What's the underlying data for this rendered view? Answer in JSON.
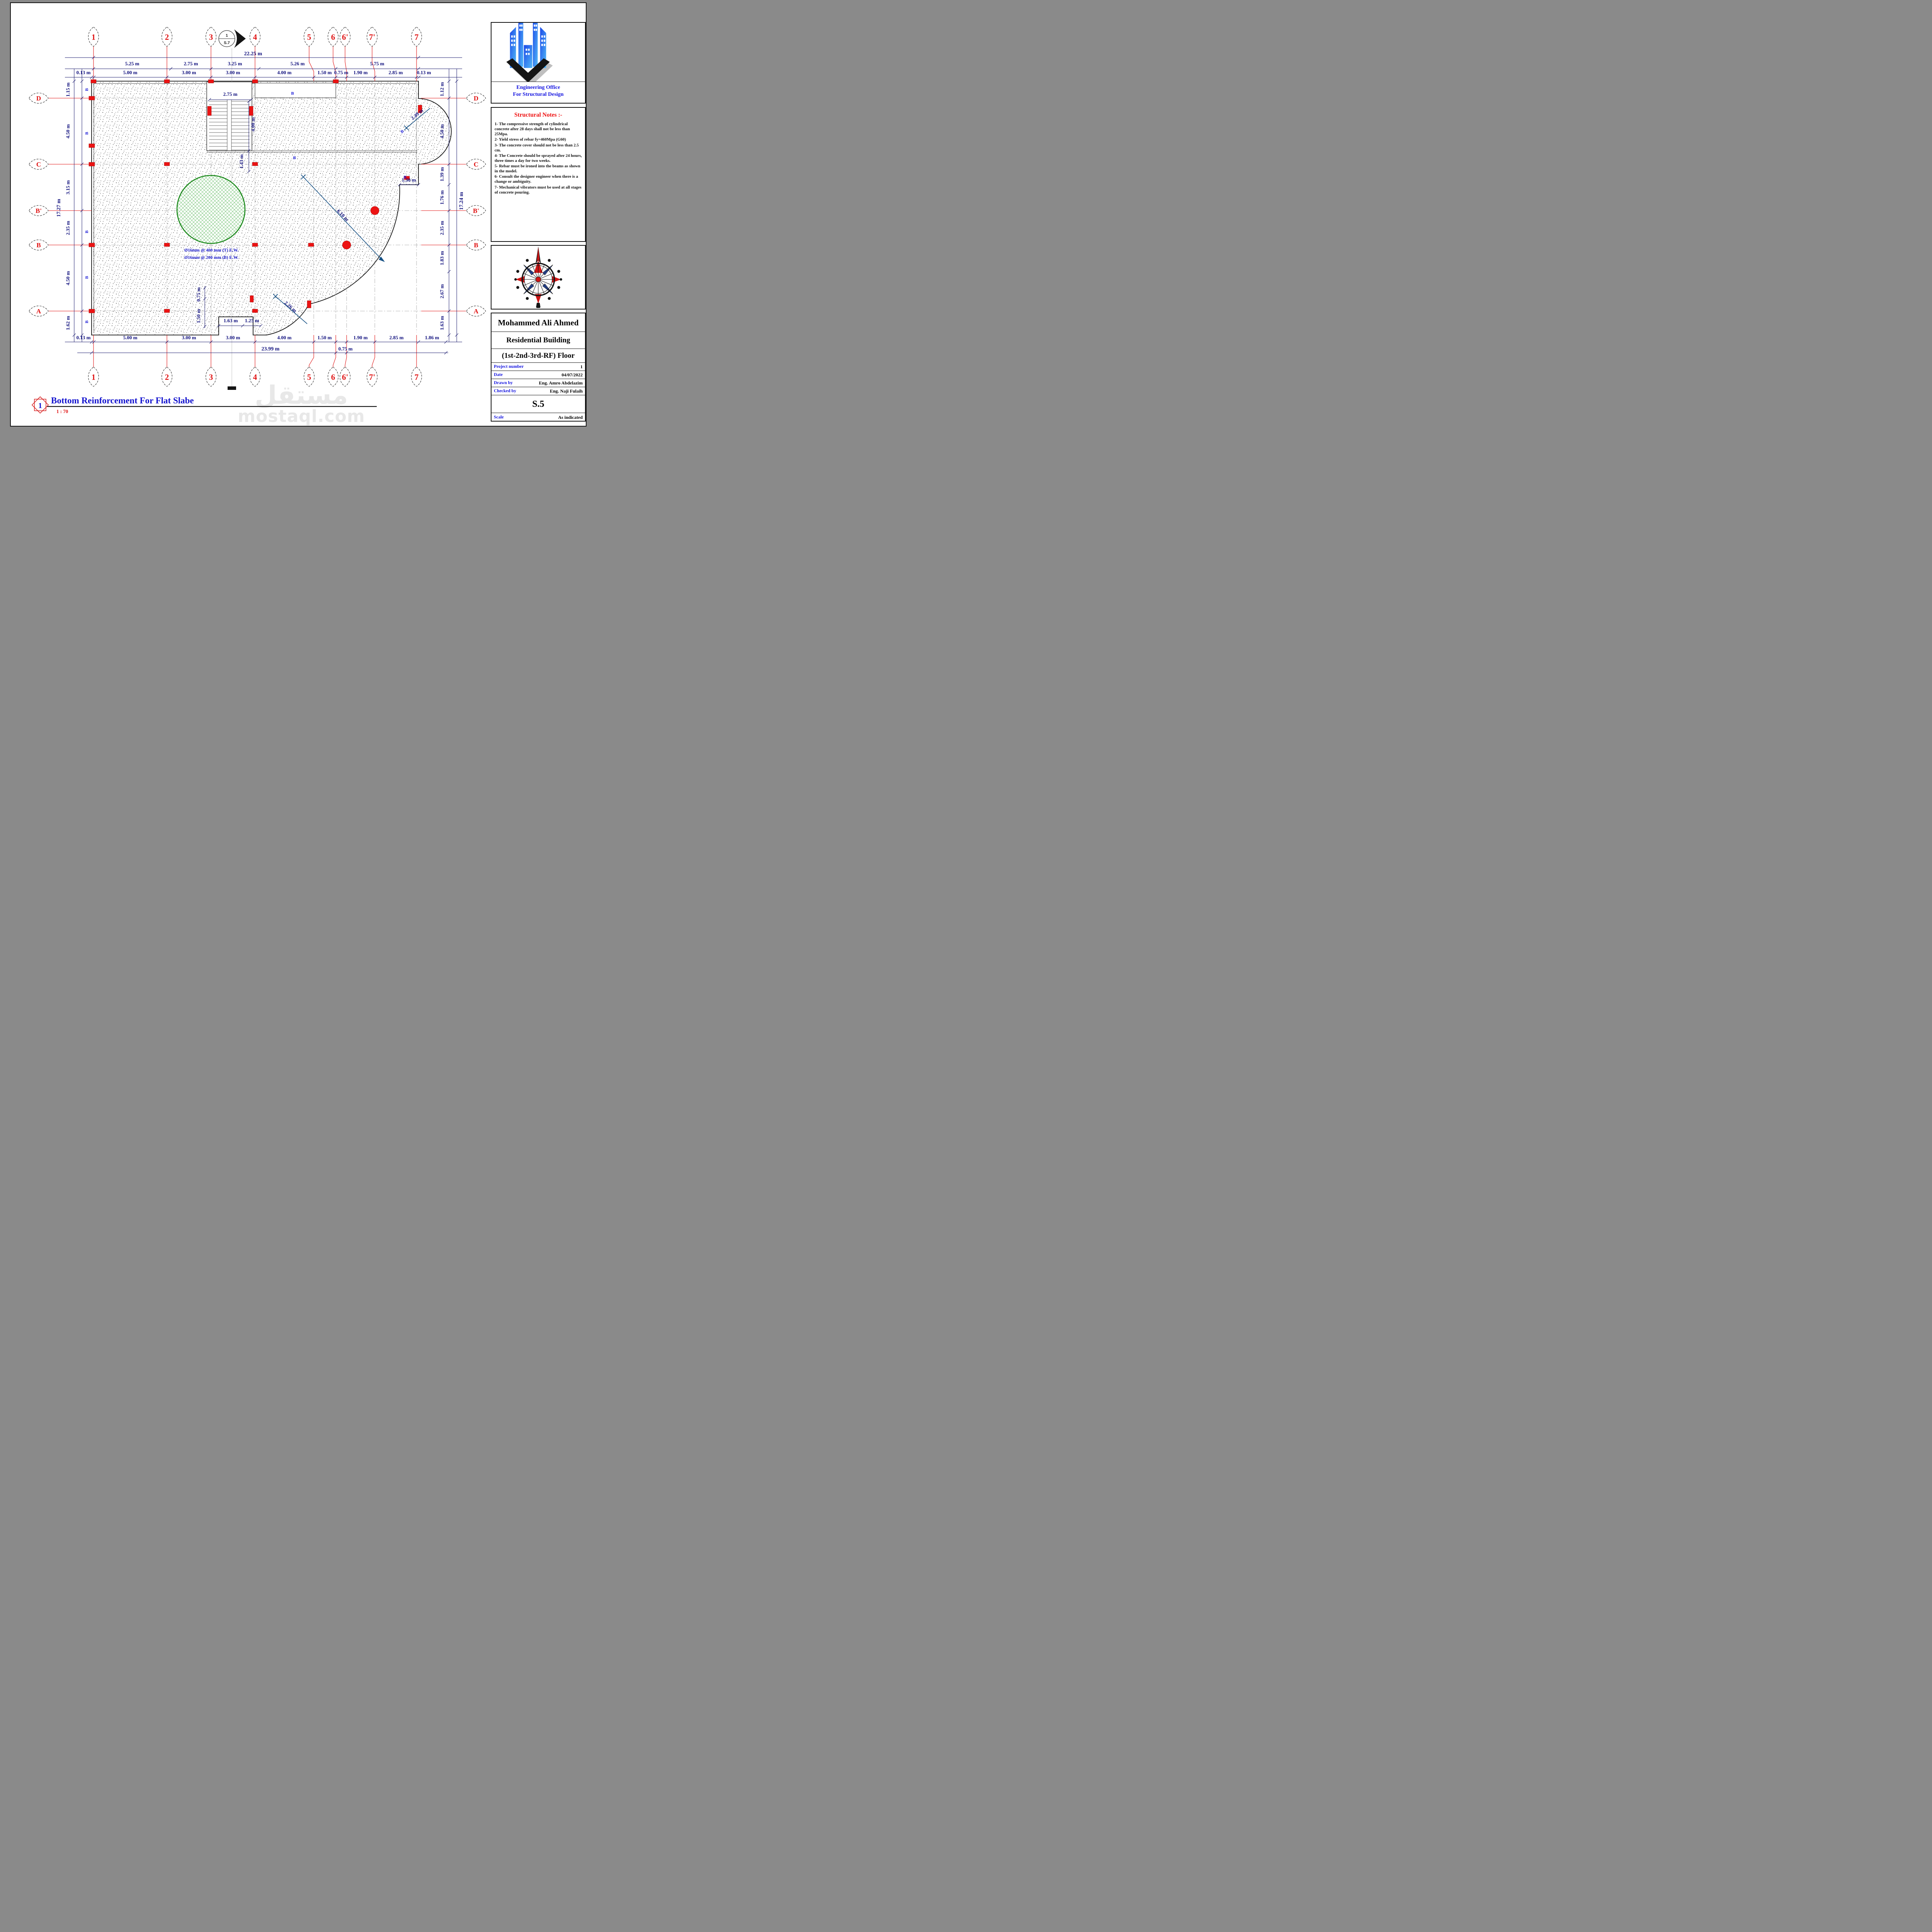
{
  "sheet": {
    "viewport_number": "1",
    "drawing_title": "Bottom Reinforcement For Flat Slabe",
    "drawing_scale": "1 : 70",
    "watermark_line1": "مستقل",
    "watermark_line2": "mostaql.com"
  },
  "section_marker": {
    "number": "1",
    "sheet_ref": "S.7"
  },
  "grids": {
    "top": [
      "1",
      "2",
      "3",
      "4",
      "5",
      "6",
      "6'",
      "7'",
      "7"
    ],
    "bottom": [
      "1",
      "2",
      "3",
      "4",
      "5",
      "6",
      "6'",
      "7'",
      "7"
    ],
    "left": [
      "D",
      "C",
      "B'",
      "B",
      "A"
    ],
    "right": [
      "D",
      "C",
      "B'",
      "B",
      "A"
    ]
  },
  "dims": {
    "top_total": "22.25 m",
    "top_row1": [
      "5.25 m",
      "2.75 m",
      "3.25 m",
      "5.26 m",
      "5.75 m"
    ],
    "top_row2": [
      "0.13 m",
      "5.00 m",
      "3.00 m",
      "3.00 m",
      "4.00 m",
      "1.50 m",
      "0.75 m",
      "1.90 m",
      "2.85 m",
      "0.13 m"
    ],
    "bottom_row1": [
      "0.13 m",
      "5.00 m",
      "3.00 m",
      "3.00 m",
      "4.00 m",
      "1.50 m",
      "1.90 m",
      "2.85 m",
      "1.86 m"
    ],
    "bottom_total": "23.99 m",
    "bottom_mid": "0.75 m",
    "left_col": [
      "1.15 m",
      "4.50 m",
      "3.15 m",
      "2.35 m",
      "4.50 m",
      "1.62 m"
    ],
    "left_total": "17.27 m",
    "right_col": [
      "1.12 m",
      "4.50 m",
      "1.39 m",
      "1.76 m",
      "2.35 m",
      "1.83 m",
      "2.67 m",
      "1.63 m"
    ],
    "right_total": "17.24 m",
    "stair_width": "2.75 m",
    "stair_depth": "4.00 m",
    "stair_below": "1.43 m",
    "notch_right": "1.30 m",
    "radius_main": "6.10 m",
    "radius_top": "2.49 m",
    "radius_bottom": "2.26 m",
    "notch_w1": "1.63 m",
    "notch_w2": "1.25 m",
    "notch_h1": "0.75 m",
    "notch_h2": "1.50 m"
  },
  "annotations": {
    "rebar_top": "Ø16mm @ 400 mm (T) E.W.",
    "rebar_bottom": "Ø16mm @ 200 mm (B) E.W.",
    "beam": "B"
  },
  "panel": {
    "office_line1": "Engineering Office",
    "office_line2": "For Structural Design",
    "notes_title": "Structural Notes :-",
    "notes": [
      "1- The compressive strength of cylindrical concrete after 28 days shall not be less than 25Mpa.",
      "2- Yield stress of rebar fy=460Mpa (G60)",
      "3- The concrete cover should not be less than 2.5 cm.",
      "4- The Concrete should be sprayed after 24 hours, three times a day for two weeks.",
      "5- Rebar must be ironed into the beams as shown in the model.",
      "6- Consult the designer engineer when there is a change or ambiguity.",
      "7- Mechanical vibrators must be used at all stages of concrete pouring."
    ],
    "owner": "Mohammed Ali Ahmed",
    "project": "Residential Building",
    "floor": "(1st-2nd-3rd-RF) Floor",
    "fields": [
      {
        "label": "Project number",
        "value": "1"
      },
      {
        "label": "Date",
        "value": "04/07/2022"
      },
      {
        "label": "Drawn by",
        "value": "Eng. Amro Abdelazim"
      },
      {
        "label": "Checked by",
        "value": "Eng. Naji Fulaih"
      }
    ],
    "sheet_number": "S.5",
    "scale_label": "Scale",
    "scale_value": "As indicated"
  }
}
